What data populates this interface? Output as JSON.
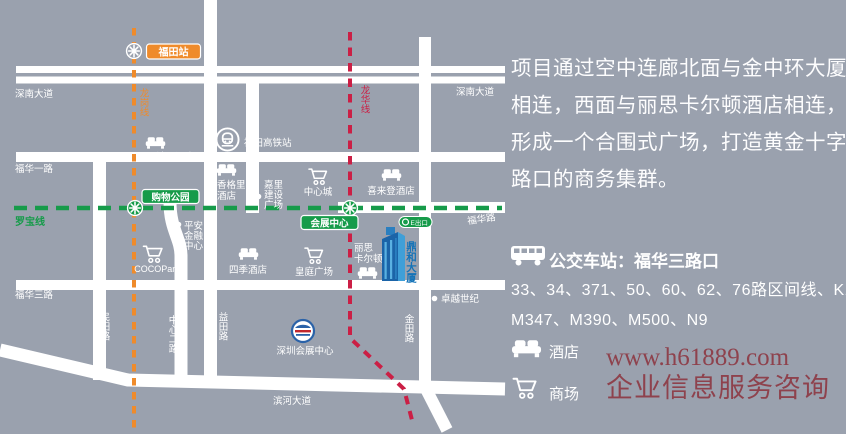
{
  "colors": {
    "background": "#9aa1ae",
    "road": "#ffffff",
    "line_luobao_green": "#169b4a",
    "line_longgang_orange": "#ef8b2b",
    "line_longhua_red": "#cb1f45",
    "building_blue": "#1b64a8",
    "watermark_red": "#8d3a45"
  },
  "map": {
    "stations": {
      "futian": "福田站",
      "shopping_park": "购物公园",
      "convention_center": "会展中心",
      "exit_badge": "E出口"
    },
    "metro_lines": {
      "luobao": "罗宝线",
      "longgang": "龙岗线",
      "longhua": "龙华线"
    },
    "roads": {
      "shennan_left": "深南大道",
      "shennan_right": "深南大道",
      "fuhua_yi": "福华一路",
      "fuhua": "福华路",
      "fuhua_san": "福华三路",
      "mintian": "民田路",
      "zhongxin_er": "中心二路",
      "yitian": "益田路",
      "jintian": "金田路",
      "binhe": "滨河大道"
    },
    "pois": {
      "marco_polo": "马可波罗酒店",
      "futian_hsr": "福田高铁站",
      "shangri_la": [
        "香格里拉",
        "酒店"
      ],
      "kerry": [
        "嘉里",
        "建设",
        "广场"
      ],
      "central_city": "中心城",
      "sheraton": "喜来登酒店",
      "pingan": [
        "平安",
        "金融",
        "中心"
      ],
      "cocopark": "COCOPark",
      "four_seasons": "四季酒店",
      "huangting": "皇庭广场",
      "ritz_carlton": [
        "丽思",
        "卡尔顿"
      ],
      "zhuoyue": "卓越世纪",
      "szcec": "深圳会展中心",
      "dinghe_tower": "鼎和大厦"
    }
  },
  "panel": {
    "paragraph": "项目通过空中连廊北面与金中环大厦相连，西面与丽思卡尔顿酒店相连，形成一个合围式广场，打造黄金十字路口的商务集群。",
    "bus": {
      "title": "公交车站：福华三路口",
      "routes_line1": "33、34、371、50、60、62、76路区间线、K113、",
      "routes_line2": "M347、M390、M500、N9"
    },
    "legend": {
      "hotel": "酒店",
      "mall": "商场"
    },
    "watermark": {
      "line1": "www.h61889.com",
      "line2": "企业信息服务咨询"
    }
  }
}
